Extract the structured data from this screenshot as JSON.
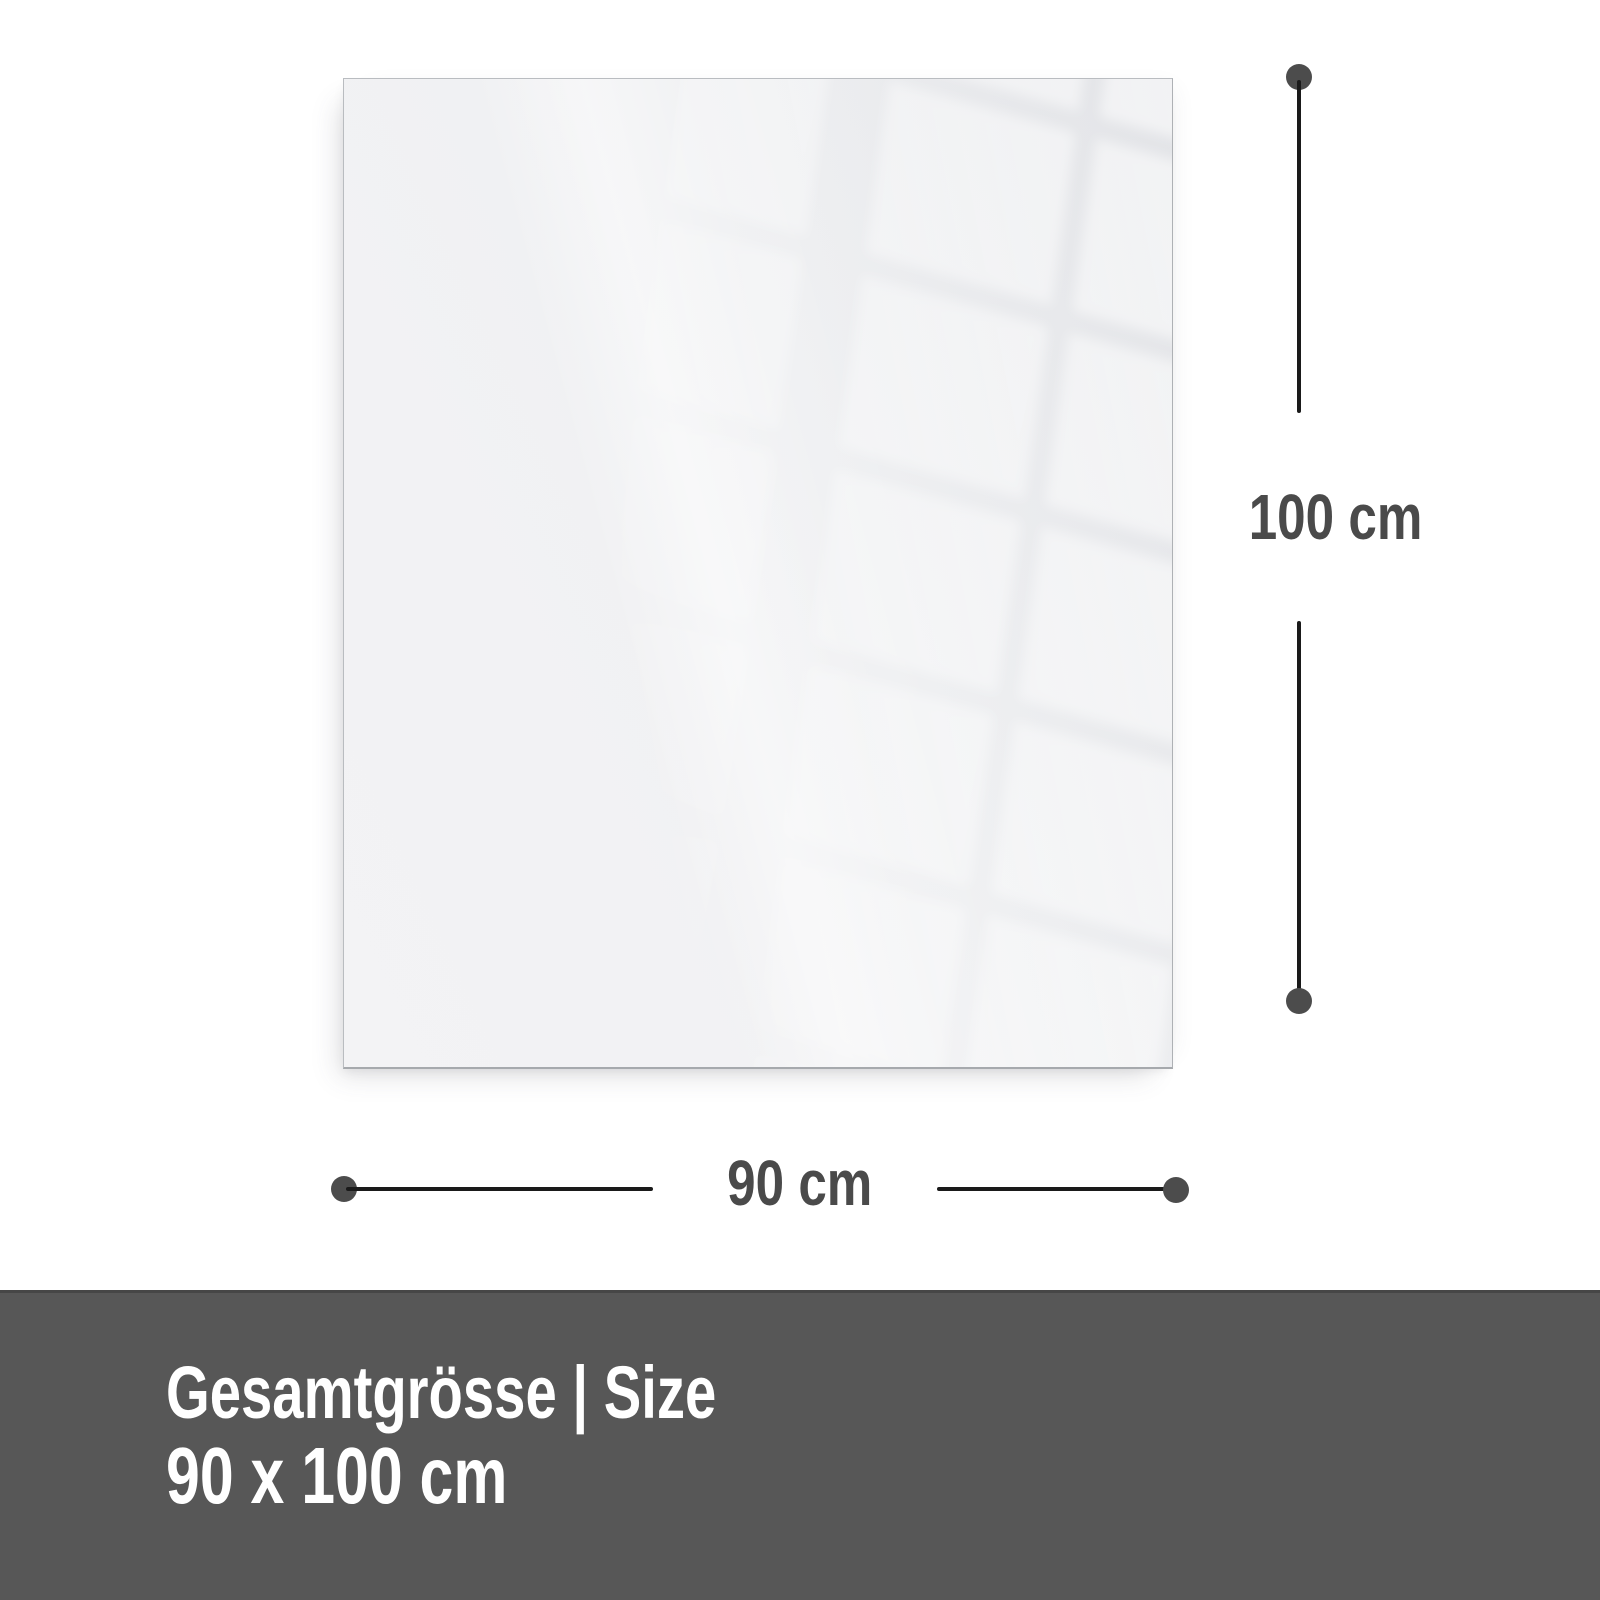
{
  "dimension_annotations": {
    "height": {
      "label": "100 cm"
    },
    "width": {
      "label": "90 cm"
    }
  },
  "footer": {
    "title": "Gesamtgrösse | Size",
    "size_value": "90 x 100 cm"
  },
  "colors": {
    "background": "#ffffff",
    "panel_base": "#f1f2f4",
    "panel_border": "#b9bcc0",
    "dimension_line": "#1a1a1a",
    "dimension_dot": "#4c4c4c",
    "dimension_label": "#4a4a4a",
    "footer_background": "#575757",
    "footer_text": "#ffffff"
  }
}
